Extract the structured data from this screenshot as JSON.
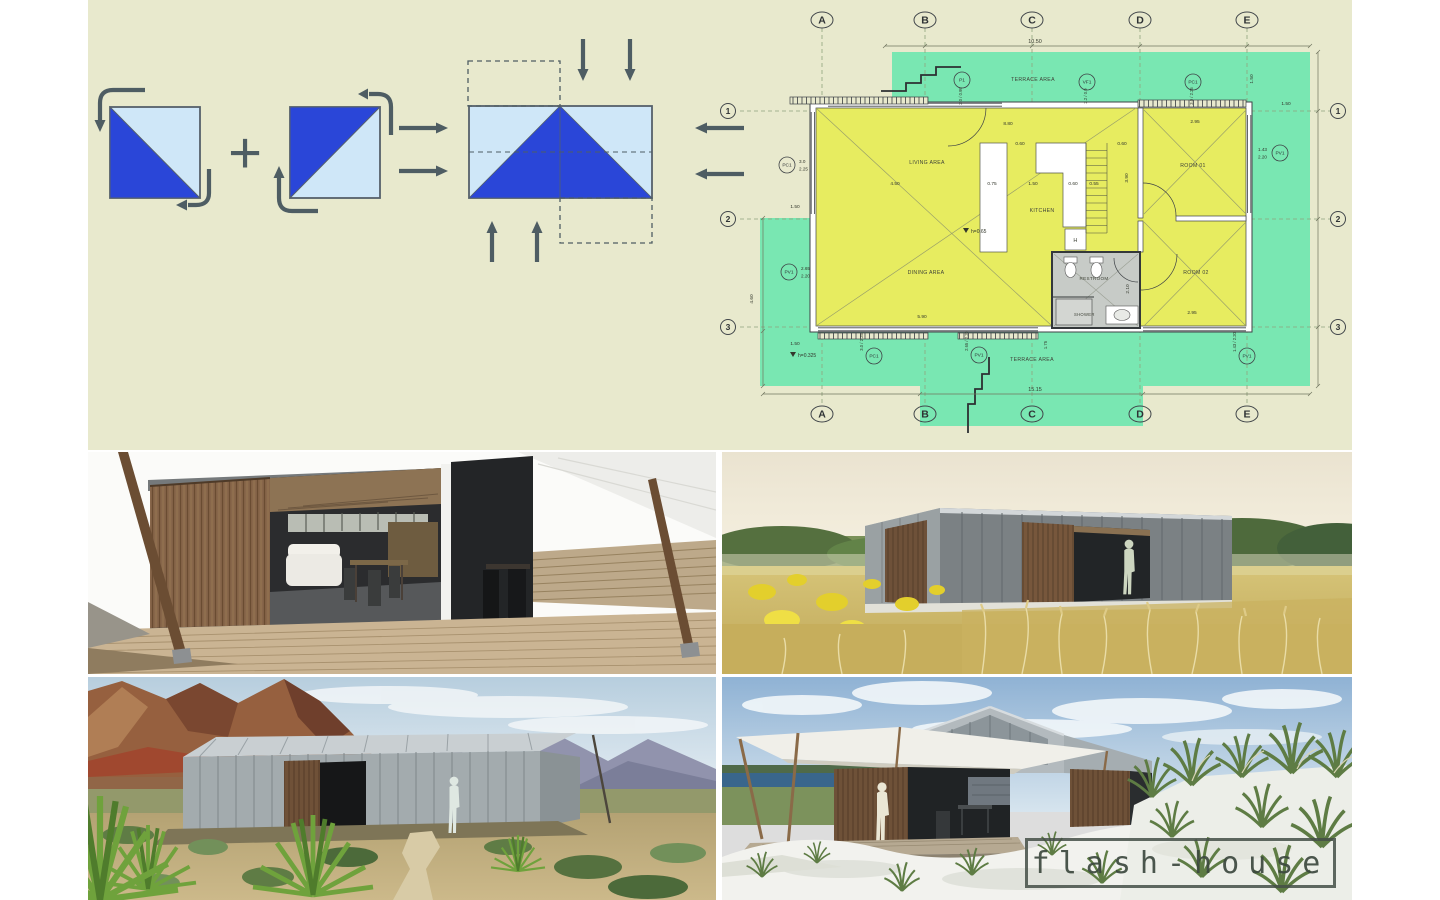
{
  "logo": {
    "text": "flash-house"
  },
  "diagram": {
    "plus": "+"
  },
  "colors": {
    "board_bg": "#e8e9cd",
    "triangle_blue": "#2a46d8",
    "triangle_light": "#cfe7f8",
    "terrace_green": "#79e7b2",
    "floor_yellow": "#e7ec60",
    "arrow_slate": "#4e5d63"
  },
  "plan": {
    "grid_letters": [
      "A",
      "B",
      "C",
      "D",
      "E"
    ],
    "grid_numbers": [
      "1",
      "2",
      "3"
    ],
    "rooms": {
      "terrace_top": "TERRACE AREA",
      "living": "LIVING AREA",
      "kitchen": "KITCHEN",
      "dining": "DINING AREA",
      "room1": "ROOM 01",
      "room2": "ROOM 02",
      "restroom": "RESTROOM",
      "shower": "SHOWER",
      "heater": "H",
      "terrace_bottom": "TERRACE AREA"
    },
    "levels": {
      "main": "h=0.65",
      "terrace": "h=0.325"
    },
    "tags": {
      "p1": "P1",
      "vf1": "VF1",
      "pc1_top": "PC1",
      "pc1_left": "PC1",
      "pv1_left": "PV1",
      "pv1_right": "PV1",
      "pc1_bottom": "PC1",
      "pv1_bottom": "PV1",
      "pv1_bottom_right": "PV1"
    },
    "tag_dims": {
      "p1": "2.0 / 0.95",
      "vf1": "2.2 / 0.9",
      "pc1_top": "3.0 / 2.25",
      "pc1_left_w": "3.0",
      "pc1_left_h": "2.25",
      "pv1_left_w": "2.65",
      "pv1_left_h": "2.20",
      "pv1_right_w": "1.43",
      "pv1_right_h": "2.20",
      "pc1_bottom": "3.0 / 2.25",
      "pv1_bottom": "2.65 / 2.20",
      "pv1_bottom_right": "1.43 / 2.20",
      "stair": "1.75"
    },
    "dims": {
      "top": "10.50",
      "bottom": "15.15",
      "living_top": "8.80",
      "living_w": "4.50",
      "dining_w": "5.90",
      "room1_w": "2.95",
      "room2_w": "2.95",
      "kitchen_a": "0.75",
      "kitchen_b": "1.50",
      "kitchen_c": "0.60",
      "kitchen_d": "0.55",
      "kitchen_e": "0.60",
      "kitchen_f": "0.60",
      "room_v": "2.10",
      "kitchen_v": "3.90",
      "left_a": "1.50",
      "left_b": "4.60",
      "left_c": "1.50",
      "right_v": "1.50",
      "right_h": "1.50"
    }
  }
}
